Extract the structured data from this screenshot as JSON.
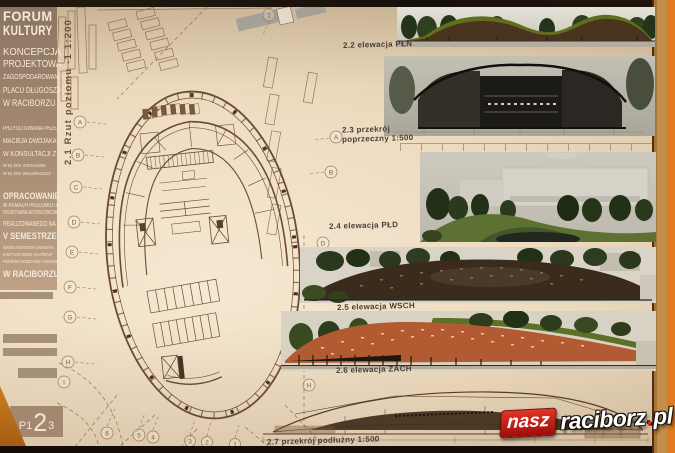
{
  "sidebar": {
    "title": [
      "FORUM",
      "KULTURY"
    ],
    "subtitle": [
      "KONCEPCJA",
      "PROJEKTOWA",
      "ZAGOSPODAROWANIA",
      "PLACU DŁUGOSZA",
      "W RACIBORZU"
    ],
    "prepared": [
      "PRZYGOTOWANA PRZEZ",
      "MACIEJA DWOJAKA",
      "W KONSULTACJI Z",
      "DR INŻ. ARCH. JERZYM CIBISEM",
      "DR INŻ. ARCH. WIESŁAWEM OLEJKO"
    ],
    "elaboration": [
      "OPRACOWANIE",
      "W RAMACH PRZEDMIOTU",
      "PROJEKTOWANIE ARCHITEKTONICZNE",
      "REALIZOWANEGO NA",
      "V SEMESTRZE",
      "KIERUNKU ARCHITEKTURA I URBANISTYKA",
      "W INSTYTUCIE TECHNIKI I ARCHITEKTURY",
      "PAŃSTWOWEJ WYŻSZEJ SZKOŁY ZAWODOWEJ",
      "W RACIBORZU"
    ],
    "page_label": {
      "prefix": "P1",
      "big": "2",
      "suffix": "3"
    }
  },
  "plan": {
    "label": "2.1 Rzut poziomu -1 1:200",
    "grid_letters_left": [
      "A",
      "B",
      "C",
      "D",
      "E",
      "F",
      "G",
      "H",
      "I"
    ],
    "grid_letters_right": [
      "A",
      "B",
      "D",
      "H"
    ],
    "grid_numbers_bottom": [
      "6",
      "5",
      "4",
      "3",
      "2",
      "1"
    ],
    "grid_number_top": "1"
  },
  "panels": [
    {
      "label": "2.2 elewacja PŁN"
    },
    {
      "label": "2.3 przekrój",
      "label2": "poprzeczny 1:500"
    },
    {
      "label": "2.4 elewacja PŁD"
    },
    {
      "label": "2.5 elewacja WSCH"
    },
    {
      "label": "2.6 elewacja ZACH"
    },
    {
      "label": "2.7 przekrój podłużny 1:500"
    }
  ],
  "watermark": {
    "name": "nasz",
    "site": "raciborz",
    "dot": ".",
    "tld": "pl"
  },
  "colors": {
    "paper": "#eedcc1",
    "sidebar": "#a78c74",
    "photo_frame": "#20160e",
    "wood_edge": "#c48d49",
    "accent_red": "#c81710",
    "plan_line": "#7d5c40",
    "roof_terracotta": "#b25b32",
    "roof_green": "#5f6f1e"
  }
}
